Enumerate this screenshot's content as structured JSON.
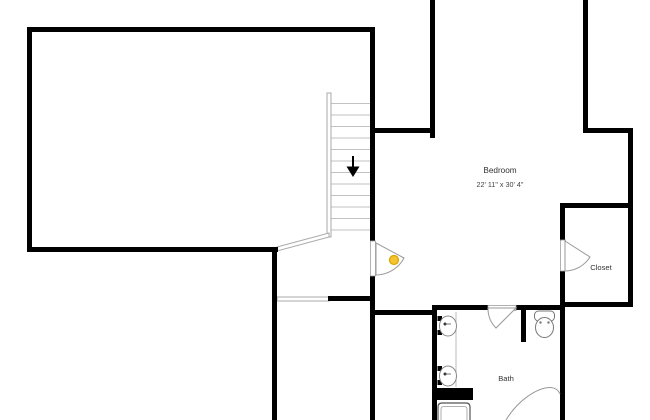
{
  "floorplan": {
    "rooms": [
      {
        "name": "Bedroom",
        "dimensions": "22' 11\" x 30' 4\""
      },
      {
        "name": "Closet"
      },
      {
        "name": "Bath"
      }
    ],
    "stairs": {
      "direction": "down"
    },
    "camera_marker": {
      "color": "#F4C430"
    },
    "fixtures": [
      "stairs",
      "double-vanity-sinks",
      "toilet",
      "shower",
      "tub"
    ],
    "colors": {
      "walls": "#000000",
      "door_lines": "#999999",
      "stair_treads": "#c2c2c2",
      "background": "#ffffff",
      "label_text": "#333333"
    }
  }
}
